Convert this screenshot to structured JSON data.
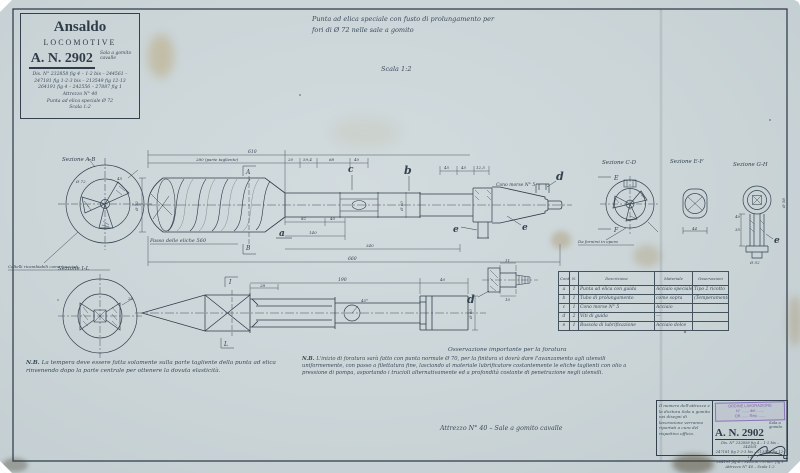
{
  "colors": {
    "paper": "#cbd5d8",
    "ink": "#2f3d4a",
    "handwriting": "#3a4a5a",
    "stamp_purple": "#7d66ad",
    "stain": "#b29658"
  },
  "header": {
    "brand1": "Ansaldo",
    "brand2": "LOCOMOTIVE",
    "number": "A. N. 2902",
    "annot1": "Sala a gomito",
    "annot2": "cavalle",
    "line1": "Dis. N° 232858 fig 4 – 1-2 bis – 244561 –",
    "line2": "247181 fig 1-2-3 bis – 213549 fig 12-13",
    "line3": "264191 fig 4 – 242556 – 27887 fig 1",
    "line4": "Attrezzo N° 40",
    "line5": "Punta ad elica speciale Ø 72",
    "line6": "Scala 1:2"
  },
  "title": {
    "line1": "Punta ad elica speciale con fusto di prolungamento per",
    "line2": "fori di Ø 72 nelle sale a gomito",
    "scale": "Scala 1:2"
  },
  "sections": {
    "ab": "Sezione A-B",
    "cd": "Sezione C-D",
    "ef": "Sezione E-F",
    "gh": "Sezione G-H",
    "il": "Sezione I-L"
  },
  "labels": {
    "cutters_note": "Coltelli ricambiabili come tracciati",
    "pitch_note": "Passo delle eliche 560",
    "cone_note": "Cono morse N° 5",
    "supply_note": "Da fornirsi in opera",
    "marker_a": "A",
    "marker_b": "B",
    "marker_e": "E",
    "marker_f": "F",
    "marker_i": "I",
    "marker_l": "L"
  },
  "parts": {
    "a": "a",
    "b": "b",
    "c": "c",
    "d": "d",
    "e": "e"
  },
  "dims": {
    "d610": "610",
    "cutting": "280 (parte tagliente)",
    "d20": "20",
    "d594": "59,4",
    "d68": "68",
    "d40a": "40",
    "d45a": "45",
    "d45b": "45",
    "d125": "12,5",
    "d82": "82",
    "d40b": "40",
    "d140": "140",
    "d340": "340",
    "d660": "660",
    "dia72": "Ø 72",
    "dia60": "Ø 60",
    "ab45": "45",
    "ef44": "44",
    "gh40": "40",
    "gh35": "35",
    "gh52": "Ø 52",
    "gh58": "Ø 58",
    "rod28": "28",
    "rod190": "190",
    "rod40": "40",
    "rod45": "45°",
    "roddia60": "Ø 60",
    "scr11": "11",
    "scr10": "10"
  },
  "table": {
    "h_mark": "Contrassegno",
    "h_qty": "N.",
    "h_desc": "Descrizione",
    "h_mat": "Materiale",
    "h_obs": "Osservazioni",
    "rows": [
      {
        "mark": "a",
        "qty": "1",
        "desc": "Punta ad elica con guida",
        "mat": "Acciaio speciale",
        "obs": "Tipo 2 ricotto"
      },
      {
        "mark": "b",
        "qty": "1",
        "desc": "Tubo di prolungamento",
        "mat": "come sopra",
        "obs": "(Temperamento)"
      },
      {
        "mark": "c",
        "qty": "1",
        "desc": "Cono morse N° 5",
        "mat": "Acciaio",
        "obs": ""
      },
      {
        "mark": "d",
        "qty": "2",
        "desc": "Viti di guida",
        "mat": "—",
        "obs": ""
      },
      {
        "mark": "e",
        "qty": "1",
        "desc": "Bussola di lubrificazione",
        "mat": "Acciaio dolce",
        "obs": ""
      }
    ]
  },
  "notes": {
    "nb": "N.B.",
    "left": "La tempera deve essere fatta solamente sulla parte tagliente della punta ad elica rinvenendo dopo la parte centrale per ottenere la dovuta elasticità.",
    "obs_heading": "Osservazione importante per la foratura",
    "mid": "L'inizio di foratura sarà fatto con punta normale Ø 70, per la finitura si dovrà dare l'avanzamento agli utensili uniformemente, con passo a filettatura fine, lasciando al materiale lubrificatore costantemente le eliche taglienti con olio a pressione di pompa, asportando i trucioli alternativamente ed a profondità costante di penetrazione negli utensili.",
    "tool_line": "Attrezzo N° 40 – Sale a gomito cavalle"
  },
  "titleblock": {
    "note": "Il numero dell'attrezzo e la dicitura Sala a gomito nei disegni di lavorazione verranno riportati a cura del rispettivo ufficio.",
    "stamp1": "ORDINE LAVORAZIONE",
    "stamp2": "N° ....... del .......",
    "stamp3": "Off. ...... Rep. ......",
    "number": "A. N. 2902",
    "annot1": "Sala a",
    "annot2": "gomito",
    "line1": "Dis. N° 232858 fig 4 – 1-2 bis – 244561",
    "line2": "247181 fig 1-2-3 bis – 213549 fig 12-13",
    "line3": "264191 fig 4 – 242556 – 27887 fig 1",
    "line4": "Attrezzo N° 40  –  Scala 1:2"
  }
}
